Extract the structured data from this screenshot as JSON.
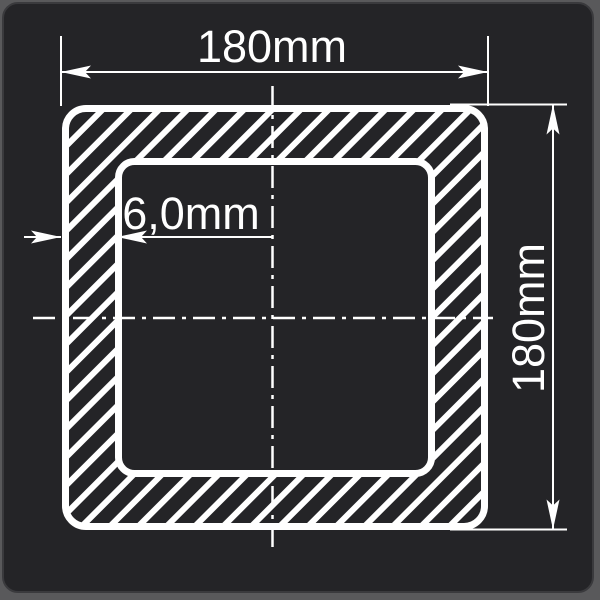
{
  "drawing": {
    "type": "cross-section-technical-drawing",
    "subject": "square hollow profile",
    "labels": {
      "outer_width": "180mm",
      "outer_height": "180mm",
      "wall_thickness": "6,0mm"
    }
  },
  "colors": {
    "background": "#59595B",
    "card": "#242427",
    "line": "#FFFFFF"
  }
}
